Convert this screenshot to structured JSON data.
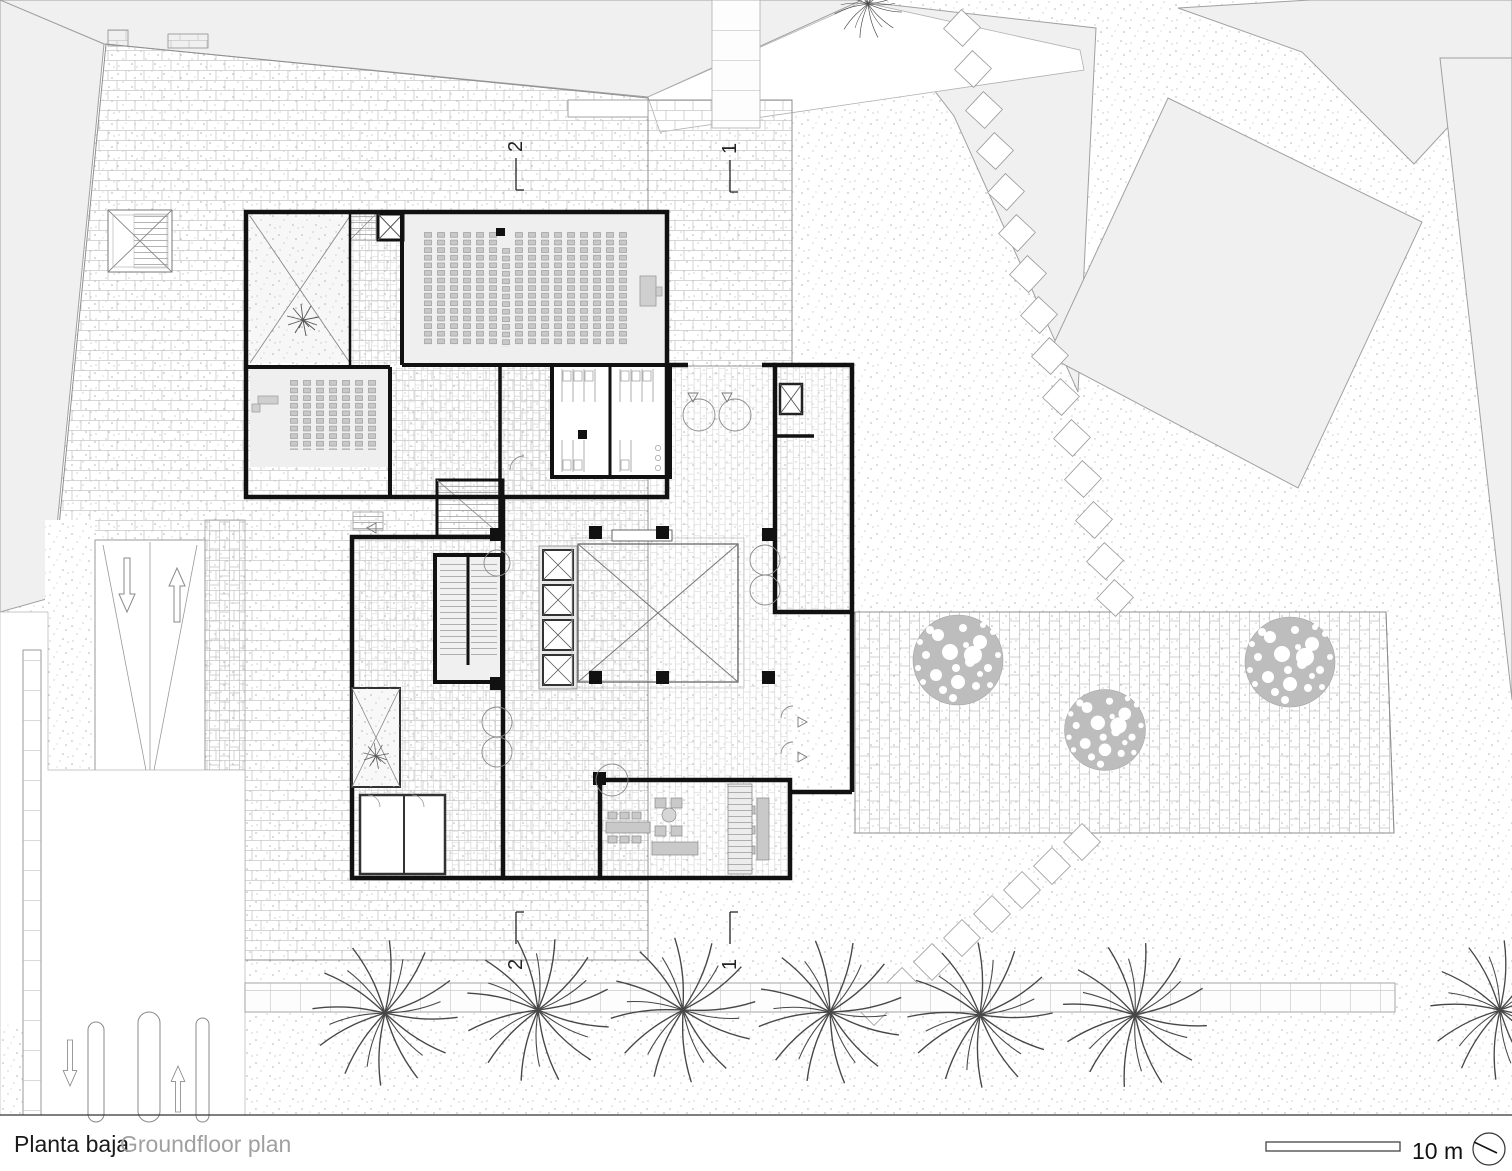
{
  "page": {
    "width": 1512,
    "height": 1171,
    "background": "#ffffff"
  },
  "caption": {
    "title_primary": "Planta baja",
    "title_secondary": "Groundfloor plan"
  },
  "scale_bar": {
    "label": "10 m"
  },
  "north_arrow": {
    "symbol": "circle-with-needle"
  },
  "section_markers": {
    "top": [
      {
        "label": "2"
      },
      {
        "label": "1"
      }
    ],
    "bottom": [
      {
        "label": "2"
      },
      {
        "label": "1"
      }
    ]
  },
  "colors": {
    "paper": "#ffffff",
    "neighbor_building_fill": "#f0f0f0",
    "site_outline": "#999999",
    "brick_joint": "#c9c9c9",
    "wall_black": "#111111",
    "seat_fill": "#c9c9c9",
    "furniture_fill": "#c9c9c9",
    "foliage_fill": "#bdbdbd",
    "text_primary": "#1a1a1a",
    "text_secondary": "#a0a0a0"
  },
  "site": {
    "ground_textures": [
      "stipple-gravel",
      "brick-plaza-running-bond",
      "brick-band-vertical-bond",
      "square-pavers"
    ],
    "features": [
      "vehicle-ramp-two-lanes",
      "street-with-islands",
      "sidewalk-with-trees",
      "stepping-stone-paths",
      "skylight-grate",
      "bench"
    ],
    "canopy_tree_count": 3,
    "branch_tree_count": 8,
    "neighbor_building_count": 6
  },
  "building": {
    "rooms": [
      "auditorium",
      "classroom",
      "entrance-patio",
      "light-court",
      "elevator-bank",
      "stair-cores",
      "toilets",
      "entry-vestibule",
      "lounge-cafe",
      "lower-patio"
    ],
    "auditorium_seat_columns": 16,
    "classroom_seat_columns": 7,
    "elevator_bank_count": 4
  }
}
